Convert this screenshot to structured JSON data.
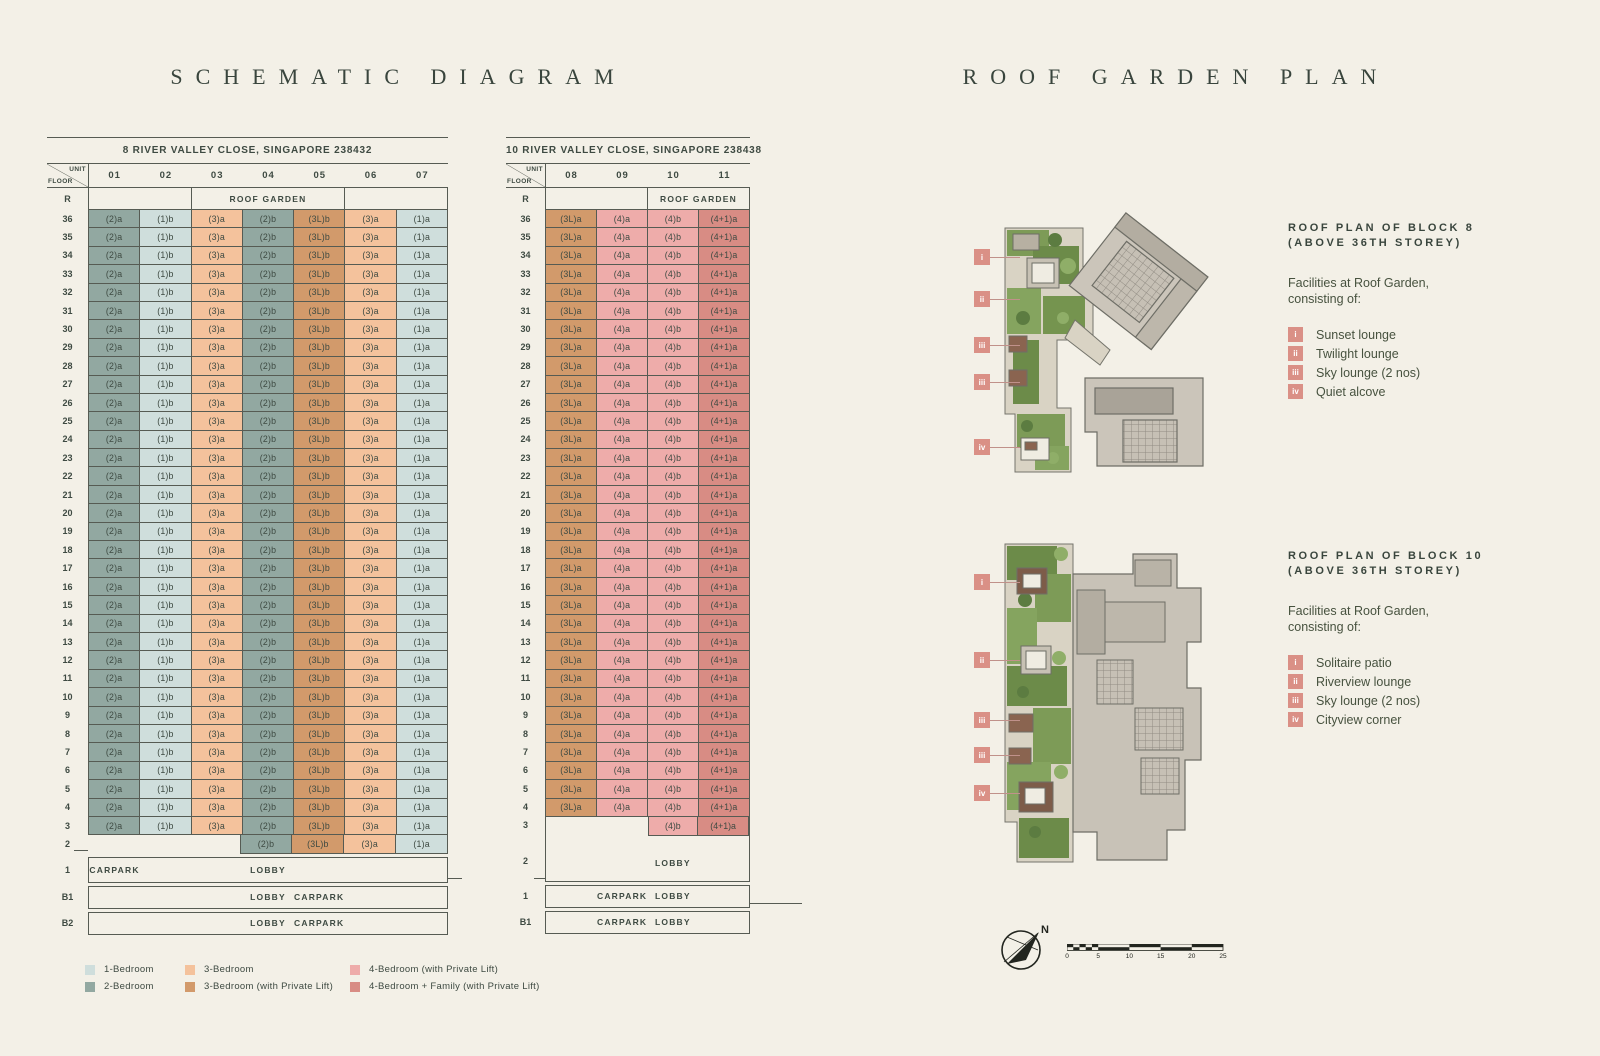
{
  "titles": {
    "left": "SCHEMATIC DIAGRAM",
    "right": "ROOF GARDEN PLAN"
  },
  "colors": {
    "bed1": "#cfdedc",
    "bed2": "#92a8a1",
    "bed3": "#f4c29c",
    "bed3L": "#d29a6b",
    "bed4": "#eeacaa",
    "bed4f": "#d88c84"
  },
  "block8": {
    "address": "8 RIVER VALLEY CLOSE, SINGAPORE 238432",
    "corner_top": "UNIT",
    "corner_bottom": "FLOOR",
    "units": [
      "01",
      "02",
      "03",
      "04",
      "05",
      "06",
      "07"
    ],
    "roof_label": "R",
    "roof_spans": [
      {
        "cols": 2,
        "text": ""
      },
      {
        "cols": 3,
        "text": "ROOF GARDEN"
      },
      {
        "cols": 2,
        "text": ""
      }
    ],
    "floors_typical": {
      "from": 36,
      "to": 3
    },
    "unit_row": [
      {
        "t": "(2)a",
        "c": "bed2"
      },
      {
        "t": "(1)b",
        "c": "bed1"
      },
      {
        "t": "(3)a",
        "c": "bed3"
      },
      {
        "t": "(2)b",
        "c": "bed2"
      },
      {
        "t": "(3L)b",
        "c": "bed3L"
      },
      {
        "t": "(3)a",
        "c": "bed3"
      },
      {
        "t": "(1)a",
        "c": "bed1"
      }
    ],
    "floor2": {
      "label": "2",
      "skip_cols": 3,
      "cells": [
        {
          "t": "(2)b",
          "c": "bed2"
        },
        {
          "t": "(3L)b",
          "c": "bed3L"
        },
        {
          "t": "(3)a",
          "c": "bed3"
        },
        {
          "t": "(1)a",
          "c": "bed1"
        }
      ]
    },
    "footers": [
      {
        "label": "1",
        "texts": [
          {
            "t": "CARPARK",
            "under": "01"
          },
          {
            "t": "LOBBY",
            "under": "04"
          }
        ]
      },
      {
        "label": "B1",
        "texts": [
          {
            "t": "LOBBY",
            "under": "04"
          },
          {
            "t": "CARPARK",
            "under": "05"
          }
        ]
      },
      {
        "label": "B2",
        "texts": [
          {
            "t": "LOBBY",
            "under": "04"
          },
          {
            "t": "CARPARK",
            "under": "05"
          }
        ]
      }
    ]
  },
  "block10": {
    "address": "10 RIVER VALLEY CLOSE, SINGAPORE 238438",
    "corner_top": "UNIT",
    "corner_bottom": "FLOOR",
    "units": [
      "08",
      "09",
      "10",
      "11"
    ],
    "roof_label": "R",
    "roof_spans": [
      {
        "cols": 2,
        "text": ""
      },
      {
        "cols": 2,
        "text": "ROOF GARDEN"
      }
    ],
    "floors_typical": {
      "from": 36,
      "to": 4
    },
    "unit_row": [
      {
        "t": "(3L)a",
        "c": "bed3L"
      },
      {
        "t": "(4)a",
        "c": "bed4"
      },
      {
        "t": "(4)b",
        "c": "bed4"
      },
      {
        "t": "(4+1)a",
        "c": "bed4f"
      }
    ],
    "floor3": {
      "label": "3",
      "cells": [
        {
          "t": "(4)b",
          "c": "bed4"
        },
        {
          "t": "(4+1)a",
          "c": "bed4f"
        }
      ]
    },
    "floor2": {
      "label": "2",
      "text": "LOBBY",
      "under": "10"
    },
    "footers": [
      {
        "label": "1",
        "texts": [
          {
            "t": "CARPARK",
            "under": "09"
          },
          {
            "t": "LOBBY",
            "under": "10"
          }
        ]
      },
      {
        "label": "B1",
        "texts": [
          {
            "t": "CARPARK",
            "under": "09"
          },
          {
            "t": "LOBBY",
            "under": "10"
          }
        ]
      }
    ]
  },
  "legend": [
    {
      "label": "1-Bedroom",
      "c": "bed1"
    },
    {
      "label": "2-Bedroom",
      "c": "bed2"
    },
    {
      "label": "3-Bedroom",
      "c": "bed3"
    },
    {
      "label": "3-Bedroom (with Private Lift)",
      "c": "bed3L"
    },
    {
      "label": "4-Bedroom (with Private Lift)",
      "c": "bed4"
    },
    {
      "label": "4-Bedroom + Family (with Private Lift)",
      "c": "bed4f"
    }
  ],
  "roof_sections": [
    {
      "heading": "ROOF PLAN OF BLOCK 8",
      "subheading": "(ABOVE 36TH STOREY)",
      "intro_line1": "Facilities at Roof Garden,",
      "intro_line2": "consisting of:",
      "facilities": [
        {
          "num": "i",
          "label": "Sunset lounge"
        },
        {
          "num": "ii",
          "label": "Twilight lounge"
        },
        {
          "num": "iii",
          "label": "Sky lounge (2 nos)"
        },
        {
          "num": "iv",
          "label": "Quiet alcove"
        }
      ],
      "plan_markers": [
        {
          "num": "i",
          "x": 47,
          "y": 57
        },
        {
          "num": "ii",
          "x": 47,
          "y": 99
        },
        {
          "num": "iii",
          "x": 47,
          "y": 145
        },
        {
          "num": "iii",
          "x": 47,
          "y": 182
        },
        {
          "num": "iv",
          "x": 47,
          "y": 247
        }
      ]
    },
    {
      "heading": "ROOF PLAN OF BLOCK 10",
      "subheading": "(ABOVE 36TH STOREY)",
      "intro_line1": "Facilities at Roof Garden,",
      "intro_line2": "consisting of:",
      "facilities": [
        {
          "num": "i",
          "label": "Solitaire patio"
        },
        {
          "num": "ii",
          "label": "Riverview lounge"
        },
        {
          "num": "iii",
          "label": "Sky lounge (2 nos)"
        },
        {
          "num": "iv",
          "label": "Cityview corner"
        }
      ],
      "plan_markers": [
        {
          "num": "i",
          "x": 47,
          "y": 52
        },
        {
          "num": "ii",
          "x": 47,
          "y": 130
        },
        {
          "num": "iii",
          "x": 47,
          "y": 190
        },
        {
          "num": "iii",
          "x": 47,
          "y": 225
        },
        {
          "num": "iv",
          "x": 47,
          "y": 263
        }
      ]
    }
  ],
  "compass_label": "N",
  "scale_ticks": [
    "0",
    "5",
    "10",
    "15",
    "20",
    "25"
  ]
}
